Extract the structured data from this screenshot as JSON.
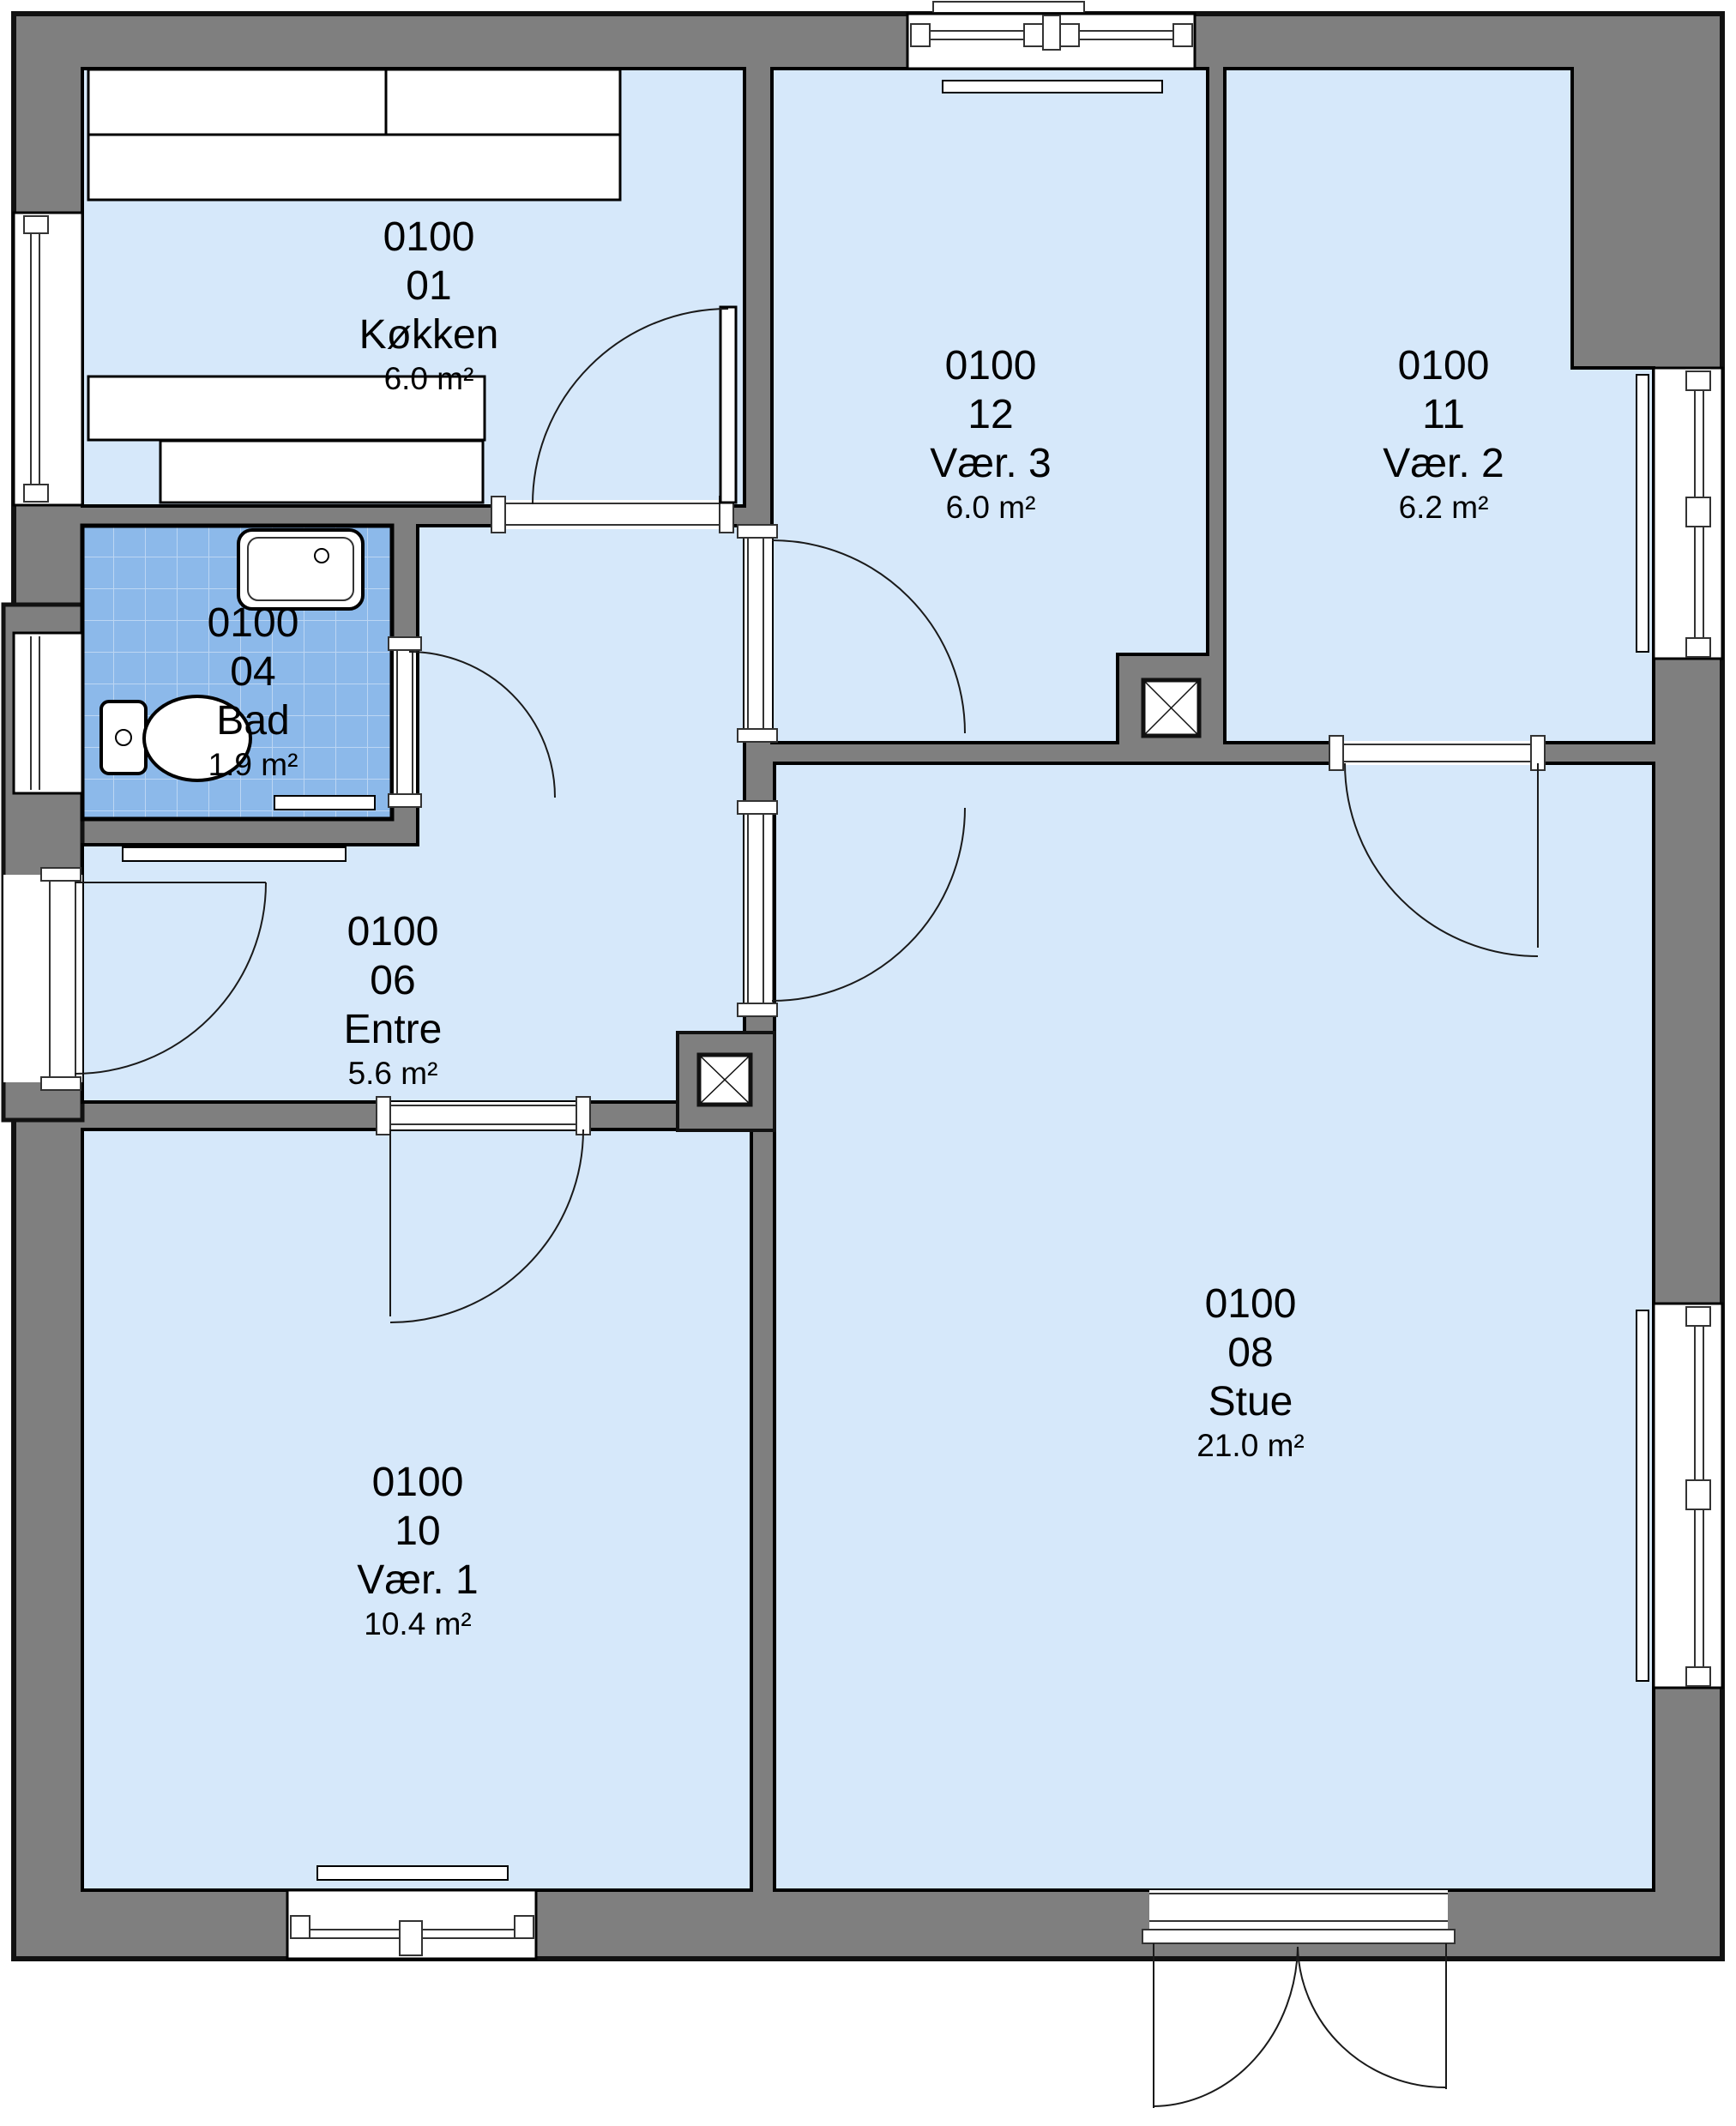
{
  "floorplan": {
    "type": "architectural-floor-plan",
    "language": "da",
    "rooms": [
      {
        "id": "koekken",
        "code": "0100",
        "number": "01",
        "name": "Køkken",
        "area": "6.0 m²"
      },
      {
        "id": "bad",
        "code": "0100",
        "number": "04",
        "name": "Bad",
        "area": "1.9 m²"
      },
      {
        "id": "entre",
        "code": "0100",
        "number": "06",
        "name": "Entre",
        "area": "5.6 m²"
      },
      {
        "id": "stue",
        "code": "0100",
        "number": "08",
        "name": "Stue",
        "area": "21.0 m²"
      },
      {
        "id": "vaer1",
        "code": "0100",
        "number": "10",
        "name": "Vær. 1",
        "area": "10.4 m²"
      },
      {
        "id": "vaer2",
        "code": "0100",
        "number": "11",
        "name": "Vær. 2",
        "area": "6.2 m²"
      },
      {
        "id": "vaer3",
        "code": "0100",
        "number": "12",
        "name": "Vær. 3",
        "area": "6.0 m²"
      }
    ],
    "colors": {
      "wall": "#7f7f7f",
      "room_floor": "#d6e8fa",
      "bath_tile": "#8cb9ea",
      "bath_tile_grout": "#bcd6f3",
      "outline": "#000000",
      "fixture": "#ffffff"
    },
    "fixtures": {
      "sink": "washbasin-with-tap",
      "toilet": "wc-with-cistern",
      "shafts": "duct-box-with-cross",
      "kitchen_counter": "worktop-run",
      "doors": "single-leaf-with-swing-arc",
      "entrance": "double-leaf-outswing",
      "windows": "double-casement-in-wall"
    }
  }
}
